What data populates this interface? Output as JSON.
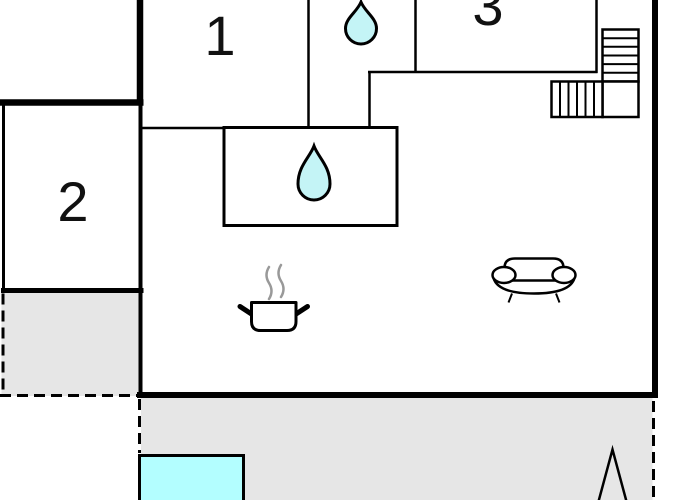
{
  "floorplan": {
    "type": "floor-plan",
    "rooms": [
      {
        "label": "1"
      },
      {
        "label": "2"
      },
      {
        "label": "3"
      }
    ],
    "features": {
      "bathroom_top": "water-drop",
      "bathroom_inner": "water-drop",
      "kitchen": "cooking-pot",
      "living_area": "sofa",
      "stairs": "staircase",
      "pool": "swimming-pool",
      "tree": "tree",
      "terraces": "dashed-outline-terrace"
    },
    "colors": {
      "wall": "#000000",
      "water_drop": "#c4f4f6",
      "pool": "#b3feff",
      "terrace": "#e6e6e6",
      "steam": "#999999"
    }
  }
}
